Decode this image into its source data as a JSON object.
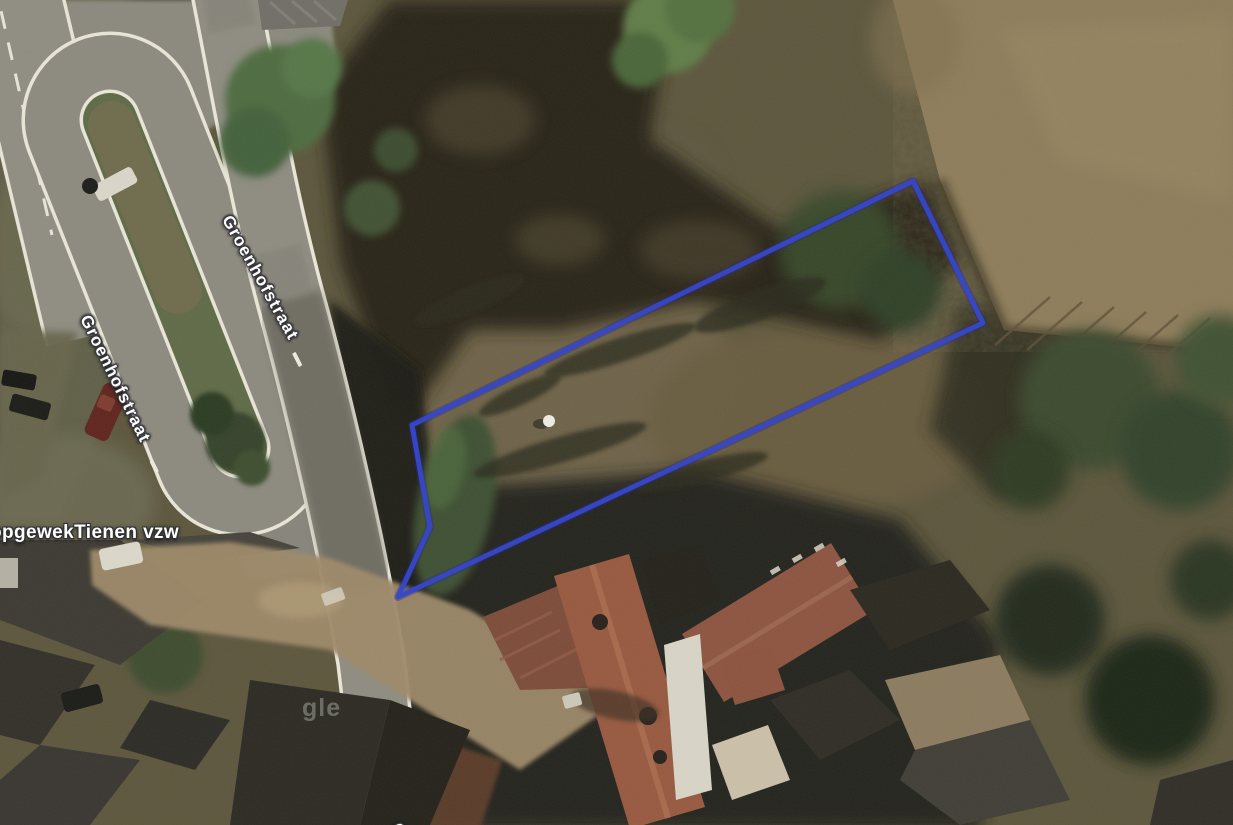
{
  "map": {
    "view_type": "satellite",
    "road_labels": [
      {
        "text": "Groenhofstraat"
      },
      {
        "text": "Groenhofstraat"
      },
      {
        "text": "G"
      }
    ],
    "poi_labels": [
      {
        "text": "opgewekTienen vzw"
      }
    ],
    "watermark_fragment": "gle",
    "parcel_outline": {
      "points": "412,425 913,181 983,323 398,597 430,527",
      "stroke_color": "#3847c8",
      "stroke_width": "5"
    },
    "palette": {
      "parcel_blue": "#3847c8",
      "field_tan": "#8d7b59",
      "lawn_olive": "#6e6448",
      "tree_dark": "#24231a",
      "road_gray": "#8d8b80",
      "curb_white": "#e8e5d7",
      "roof_red": "#96583f",
      "roof_dark": "#3b3931",
      "label_text": "#ffffff"
    }
  }
}
